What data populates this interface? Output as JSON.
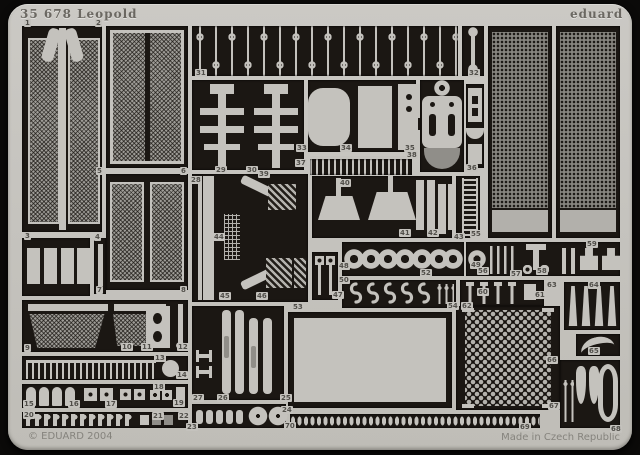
{
  "sheet": {
    "title": "35 678 Leopold",
    "brand": "eduard",
    "copyright": "© EDUARD 2004",
    "made_in": "Made in Czech Republic"
  },
  "colors": {
    "background": "#0b0a09",
    "metal_light": "#c4c2bd",
    "metal_mid": "#908e89",
    "mesh_gray": "#87857f",
    "opening_dark": "#1b1713",
    "stamp_text": "#504e49"
  },
  "part_labels": [
    {
      "n": "1",
      "x": 24,
      "y": 19
    },
    {
      "n": "2",
      "x": 95,
      "y": 19
    },
    {
      "n": "31",
      "x": 195,
      "y": 69
    },
    {
      "n": "32",
      "x": 468,
      "y": 69
    },
    {
      "n": "5",
      "x": 96,
      "y": 167
    },
    {
      "n": "6",
      "x": 180,
      "y": 167
    },
    {
      "n": "7",
      "x": 96,
      "y": 286
    },
    {
      "n": "8",
      "x": 180,
      "y": 286
    },
    {
      "n": "29",
      "x": 215,
      "y": 166
    },
    {
      "n": "30",
      "x": 246,
      "y": 166
    },
    {
      "n": "33",
      "x": 296,
      "y": 144
    },
    {
      "n": "34",
      "x": 340,
      "y": 144
    },
    {
      "n": "35",
      "x": 404,
      "y": 144
    },
    {
      "n": "36",
      "x": 466,
      "y": 164
    },
    {
      "n": "37",
      "x": 295,
      "y": 159
    },
    {
      "n": "38",
      "x": 406,
      "y": 151
    },
    {
      "n": "39",
      "x": 258,
      "y": 170
    },
    {
      "n": "28",
      "x": 190,
      "y": 176
    },
    {
      "n": "40",
      "x": 339,
      "y": 179
    },
    {
      "n": "41",
      "x": 399,
      "y": 229
    },
    {
      "n": "42",
      "x": 427,
      "y": 229
    },
    {
      "n": "43",
      "x": 453,
      "y": 233
    },
    {
      "n": "44",
      "x": 213,
      "y": 233
    },
    {
      "n": "3",
      "x": 24,
      "y": 232
    },
    {
      "n": "4",
      "x": 94,
      "y": 233
    },
    {
      "n": "45",
      "x": 219,
      "y": 292
    },
    {
      "n": "46",
      "x": 256,
      "y": 292
    },
    {
      "n": "47",
      "x": 332,
      "y": 291
    },
    {
      "n": "48",
      "x": 338,
      "y": 262
    },
    {
      "n": "50",
      "x": 338,
      "y": 276
    },
    {
      "n": "52",
      "x": 420,
      "y": 269
    },
    {
      "n": "49",
      "x": 470,
      "y": 261
    },
    {
      "n": "56",
      "x": 477,
      "y": 267
    },
    {
      "n": "57",
      "x": 510,
      "y": 270
    },
    {
      "n": "58",
      "x": 536,
      "y": 267
    },
    {
      "n": "59",
      "x": 586,
      "y": 240
    },
    {
      "n": "60",
      "x": 477,
      "y": 288
    },
    {
      "n": "61",
      "x": 534,
      "y": 291
    },
    {
      "n": "53",
      "x": 292,
      "y": 303
    },
    {
      "n": "54",
      "x": 447,
      "y": 302
    },
    {
      "n": "62",
      "x": 461,
      "y": 302
    },
    {
      "n": "9",
      "x": 24,
      "y": 344
    },
    {
      "n": "10",
      "x": 121,
      "y": 343
    },
    {
      "n": "11",
      "x": 141,
      "y": 343
    },
    {
      "n": "12",
      "x": 177,
      "y": 343
    },
    {
      "n": "13",
      "x": 154,
      "y": 354
    },
    {
      "n": "14",
      "x": 176,
      "y": 371
    },
    {
      "n": "15",
      "x": 23,
      "y": 400
    },
    {
      "n": "16",
      "x": 68,
      "y": 400
    },
    {
      "n": "17",
      "x": 105,
      "y": 400
    },
    {
      "n": "18",
      "x": 153,
      "y": 383
    },
    {
      "n": "19",
      "x": 173,
      "y": 399
    },
    {
      "n": "20",
      "x": 23,
      "y": 411
    },
    {
      "n": "21",
      "x": 152,
      "y": 412
    },
    {
      "n": "22",
      "x": 178,
      "y": 412
    },
    {
      "n": "23",
      "x": 186,
      "y": 423
    },
    {
      "n": "24",
      "x": 281,
      "y": 406
    },
    {
      "n": "25",
      "x": 280,
      "y": 394
    },
    {
      "n": "26",
      "x": 217,
      "y": 394
    },
    {
      "n": "27",
      "x": 192,
      "y": 394
    },
    {
      "n": "55",
      "x": 470,
      "y": 230
    },
    {
      "n": "63",
      "x": 546,
      "y": 281
    },
    {
      "n": "64",
      "x": 588,
      "y": 281
    },
    {
      "n": "65",
      "x": 588,
      "y": 347
    },
    {
      "n": "66",
      "x": 546,
      "y": 356
    },
    {
      "n": "67",
      "x": 548,
      "y": 402
    },
    {
      "n": "68",
      "x": 610,
      "y": 425
    },
    {
      "n": "69",
      "x": 519,
      "y": 423
    },
    {
      "n": "70",
      "x": 284,
      "y": 422
    }
  ]
}
